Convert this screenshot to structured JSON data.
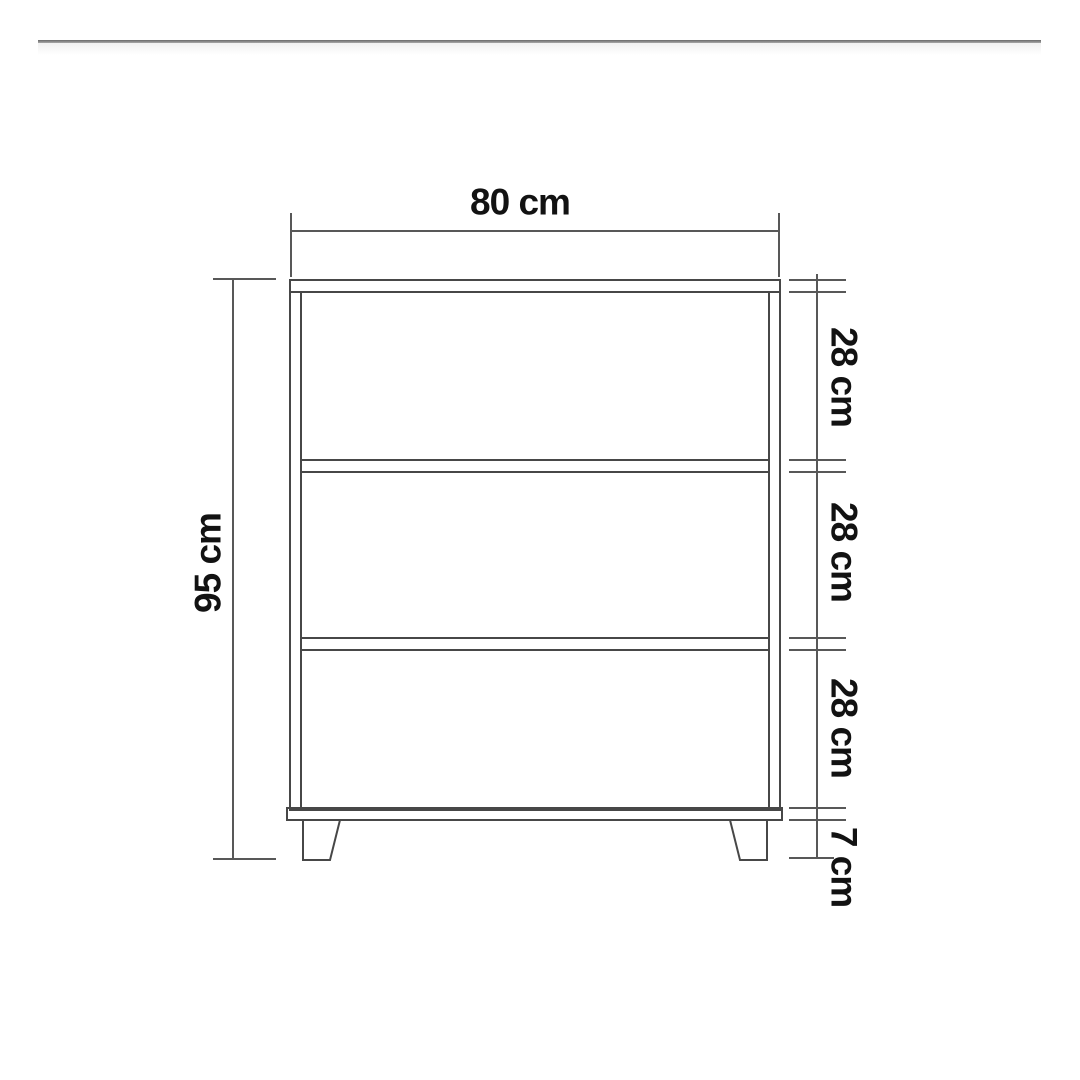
{
  "diagram": {
    "labels": {
      "width": "80 cm",
      "height": "95 cm",
      "sections": [
        "28 cm",
        "28 cm",
        "28 cm"
      ],
      "legs": "7 cm"
    },
    "colors": {
      "background": "#ffffff",
      "cabinet_line": "#474747",
      "dimension_line": "#585858",
      "text": "#121212",
      "top_rule": "#6a6a6a"
    }
  }
}
